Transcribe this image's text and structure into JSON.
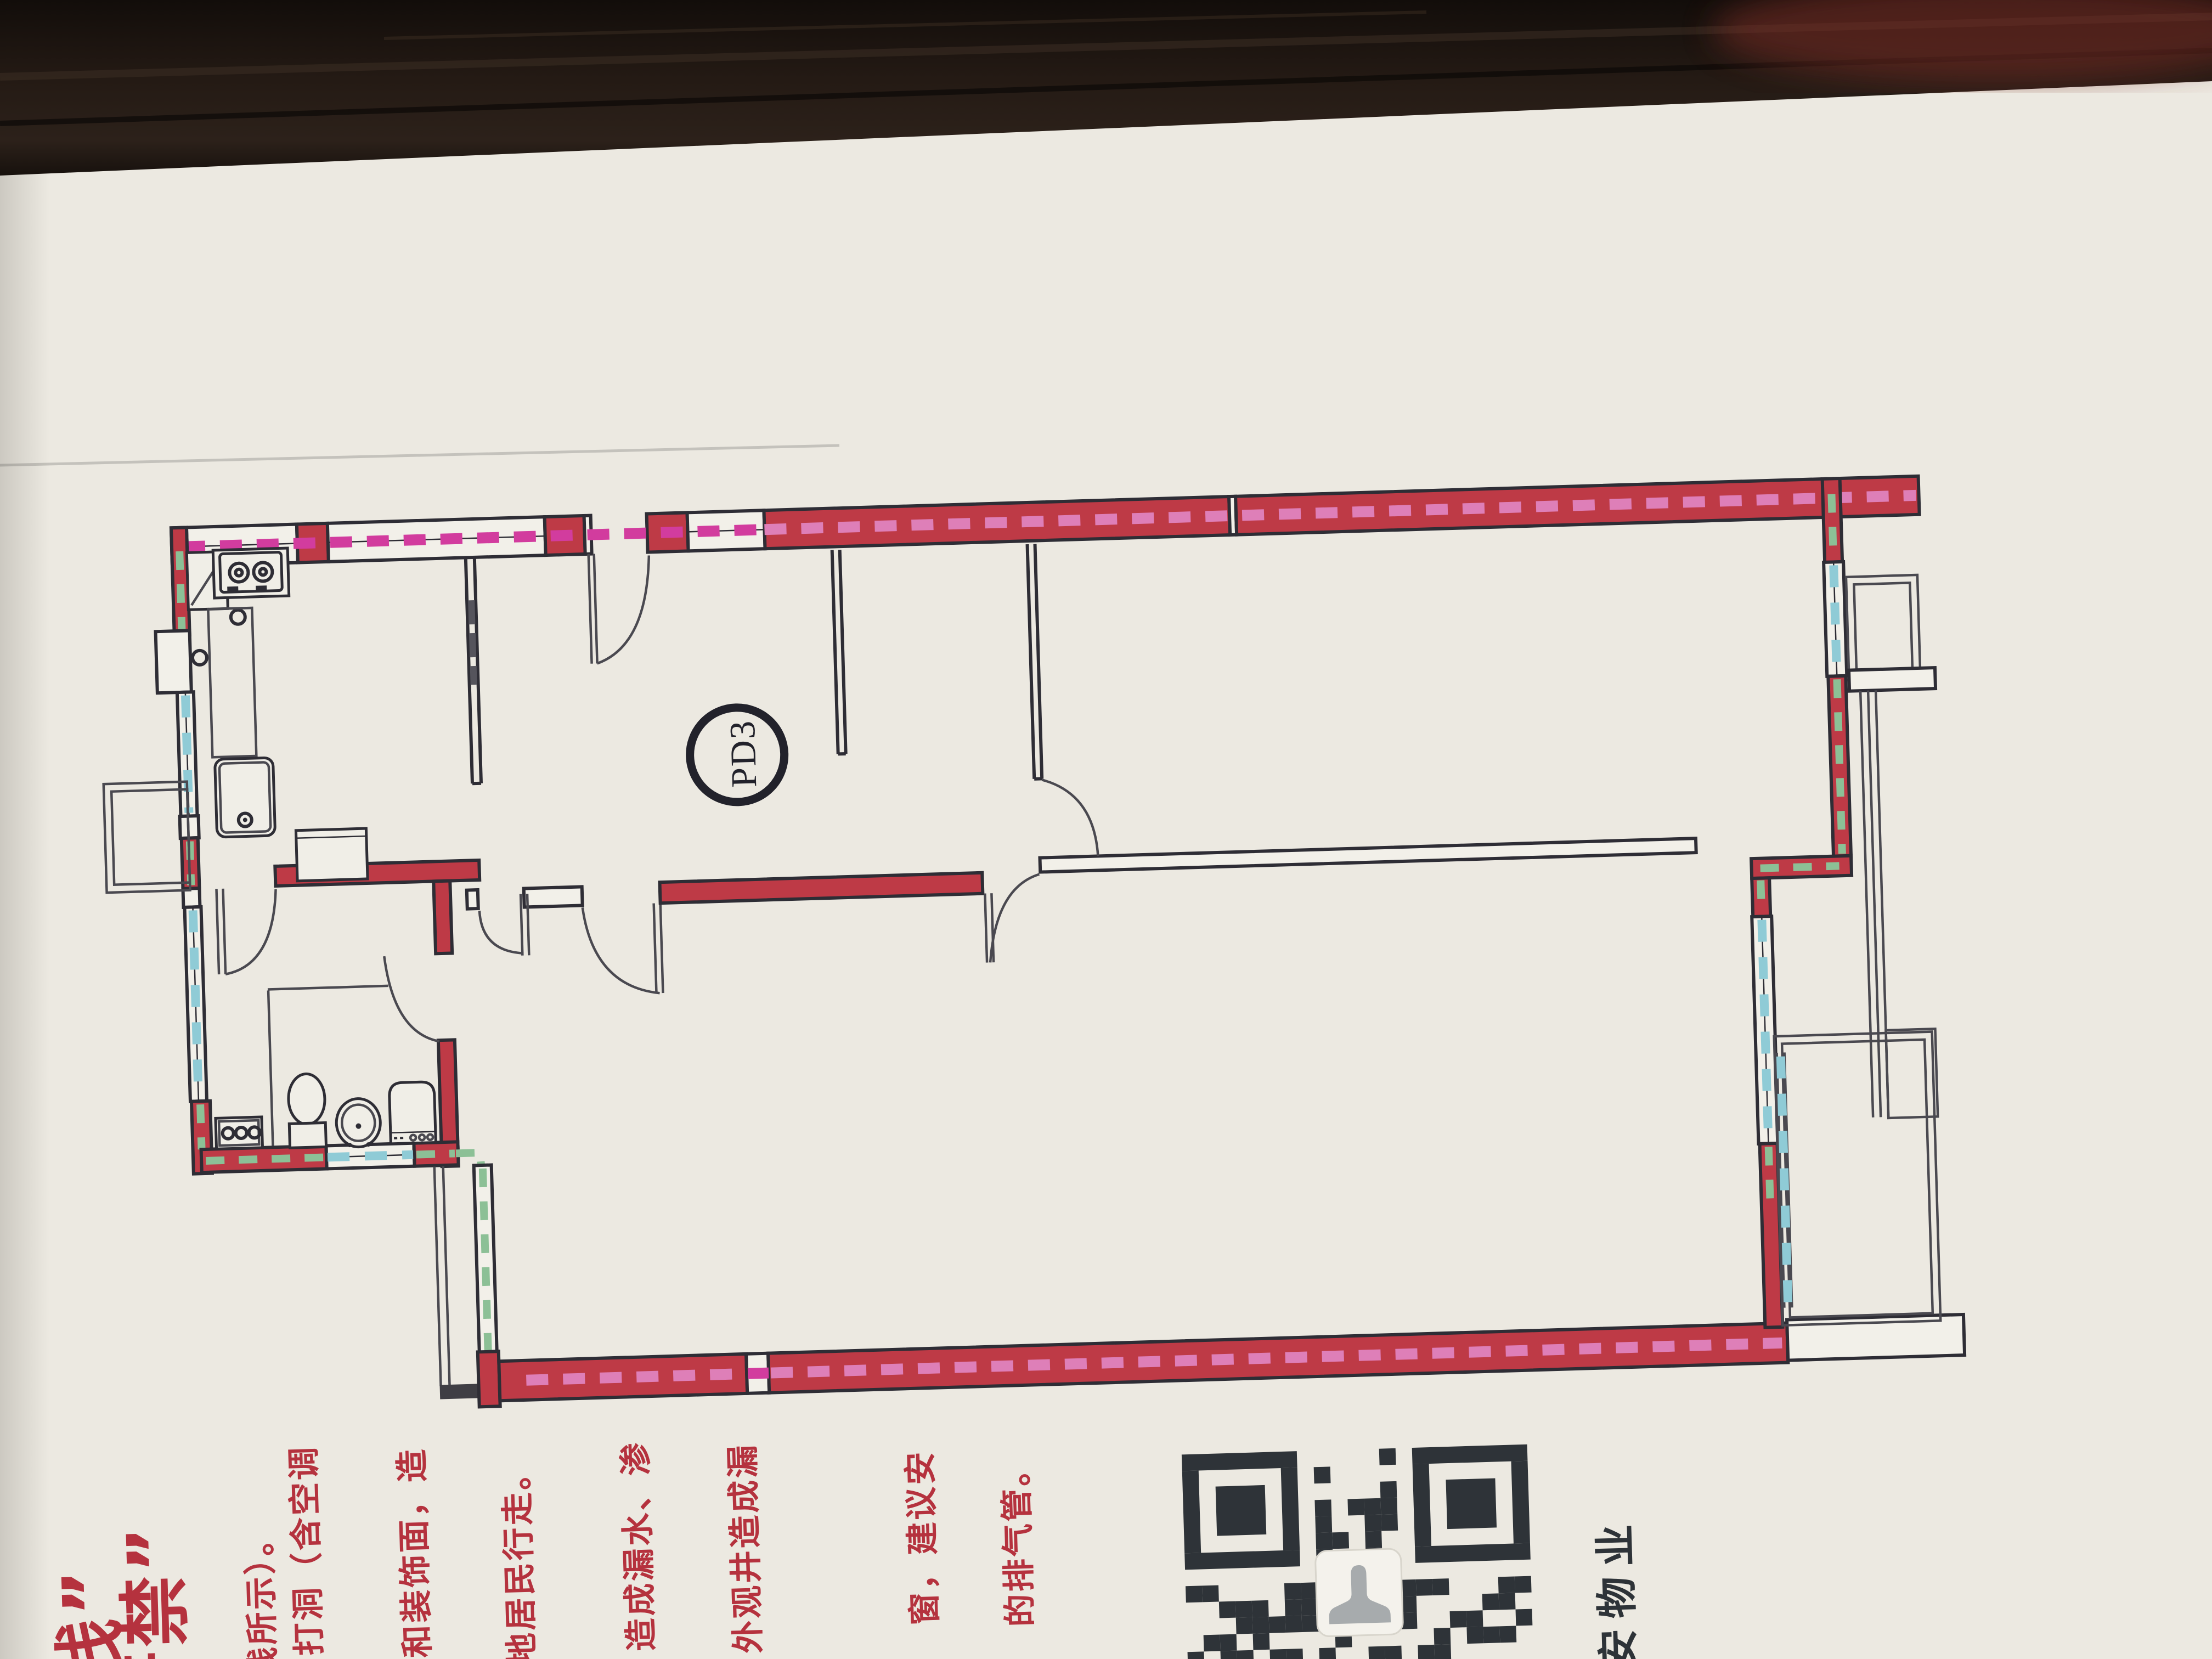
{
  "photo": {
    "surface": "dark-wood-background",
    "poster_color": "#ece9e1"
  },
  "floor_plan": {
    "shaft_label": "PD3",
    "colors": {
      "wall_highlight_red": "#be3a46",
      "dashed_magenta": "#d23c9e",
      "dashed_magenta_on_red": "#de7fb8",
      "dashed_cyan": "#8fcbd6",
      "dashed_green": "#8cc096",
      "drawing_line": "#2e2d35"
    },
    "fixtures": [
      "corner-cabinet",
      "gas-stove",
      "kitchen-sink",
      "counter",
      "appliance",
      "sliding-door",
      "entry-door",
      "toilet",
      "wash-basin",
      "washing-machine",
      "knob-panel",
      "balcony",
      "bay-window"
    ]
  },
  "notice": {
    "title_columns": [
      "线”",
      "严禁”"
    ],
    "columns": [
      "红线所示）。",
      "打洞（含空调",
      "和装饰面，造",
      "地居民行走。",
      "造成漏水、渗",
      "外观井造成漏",
      "窗，建议安",
      "的排气管。"
    ],
    "color": "#b5323e"
  },
  "qr": {
    "caption": "安物业"
  }
}
